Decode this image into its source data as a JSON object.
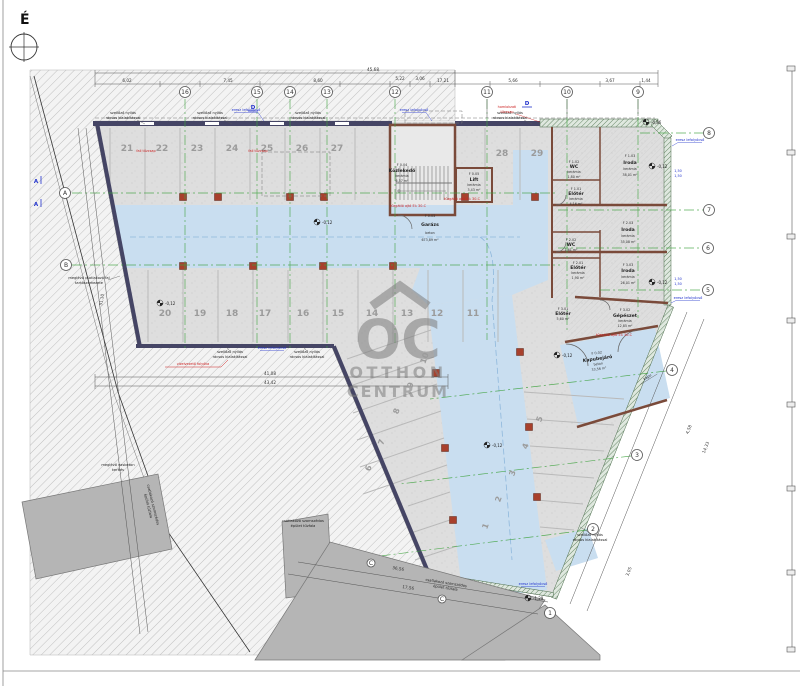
{
  "meta": {
    "north_label": "É"
  },
  "watermark": {
    "monogram": "OC",
    "line1": "OTTHON",
    "line2": "CENTRUM"
  },
  "parking": {
    "top_row": [
      "21",
      "22",
      "23",
      "24",
      "25",
      "26",
      "27",
      "28",
      "29"
    ],
    "middle_row": [
      "20",
      "19",
      "18",
      "17",
      "16",
      "15",
      "14",
      "13",
      "12",
      "11"
    ],
    "wing_left": [
      "10",
      "9",
      "8",
      "7",
      "6"
    ],
    "wing_right": [
      "5",
      "4",
      "3",
      "2",
      "1"
    ]
  },
  "grid": {
    "top": [
      "16",
      "15",
      "14",
      "13",
      "12",
      "11",
      "10",
      "9"
    ],
    "right": [
      "8",
      "7",
      "6",
      "5"
    ],
    "diagonal": [
      "4",
      "3",
      "2",
      "1"
    ],
    "left": [
      "A",
      "B"
    ],
    "sections": {
      "a": "A",
      "d": "D"
    },
    "neighbor_mark": "C"
  },
  "rooms": {
    "garage": {
      "code": "F 0.03",
      "name": "Garázs",
      "finish": "beton",
      "area": "673,89 m²"
    },
    "kozlekedo": {
      "code": "F 0.04",
      "name": "Közlekedő",
      "finish": "kerámia",
      "area": "6,57 m²"
    },
    "lift": {
      "code": "F 0.05",
      "name": "Lift",
      "finish": "kerámia",
      "area": "3,43 m²"
    },
    "wc1": {
      "code": "F 1.02",
      "name": "WC",
      "finish": "kerámia",
      "area": "1,80 m²"
    },
    "iroda1": {
      "code": "F 1.03",
      "name": "Iroda",
      "finish": "kerámia",
      "area": "38,01 m²"
    },
    "eloter1": {
      "code": "F 1.01",
      "name": "Előtér",
      "finish": "kerámia",
      "area": "4,16 m²"
    },
    "iroda2": {
      "code": "F 2.03",
      "name": "Iroda",
      "finish": "kerámia",
      "area": "35,08 m²"
    },
    "wc2": {
      "code": "F 2.02",
      "name": "WC",
      "finish": "kerámia",
      "area": "1,61 m²"
    },
    "eloter2": {
      "code": "F 2.01",
      "name": "Előtér",
      "finish": "kerámia",
      "area": "1,90 m²"
    },
    "iroda3": {
      "code": "F 3.03",
      "name": "Iroda",
      "finish": "kerámia",
      "area": "26,01 m²"
    },
    "eloter3": {
      "code": "F 3.01",
      "name": "Előtér",
      "finish": "kerámia",
      "area": "5,60 m²"
    },
    "gepeszet": {
      "code": "F 3.02",
      "name": "Gépészet",
      "finish": "kerámia",
      "area": "12,85 m²"
    },
    "kapubejaro": {
      "code": "F 0.02",
      "name": "Kapubejáró",
      "finish": "beton",
      "area": "33,56 m²"
    }
  },
  "levels": {
    "garage": "-0,12",
    "street": "-0,86",
    "gate": "-1,29"
  },
  "dimensions": {
    "top_total": "45,68",
    "t1": "6,02",
    "t2": "7,45",
    "t3": "8,60",
    "t4": "5,22",
    "t5": "3,06",
    "t6": "17,21",
    "tr1": "5,66",
    "tr2": "3,67",
    "tr3": "1,44",
    "bottom1": "41,08",
    "bottom2": "43,42",
    "left_total": "31,10",
    "wing1": "36,56",
    "wing2": "17,56",
    "se1": "4,58",
    "se2": "14,33",
    "se3": "3,05",
    "wall_r": "1,50"
  },
  "annotations": {
    "vent_l1": "szellőző nyílás",
    "vent_l2": "rácsos kialakítással",
    "gutter": "eresz lefolyócső",
    "hydrant": "fali tűzcsap",
    "facade_hydrant_l1": "homlokzati",
    "facade_hydrant_l2": "tűzcsap",
    "fire_door": "tűzgátló ajtó EI₂ 30-C",
    "drain": "vízelvezető folyóka",
    "fence_l1": "meglévő vasbeton",
    "fence_l2": "kerítés",
    "exist_l1": "meglévő csatlakozó fal",
    "exist_l2": "tartószerkezete",
    "neighbor_l1": "csatlakozó szomszédos",
    "neighbor_l2": "épület tűzfala",
    "gate": "kapu"
  },
  "colors": {
    "lane_blue": "#c9def0",
    "concrete": "#dedede",
    "hatch_line": "#ababab",
    "wall_dark": "#454565",
    "wall_green": "#5a7d5a",
    "partition_brown": "#7a4a3a",
    "column_red": "#a8402c",
    "grid_green": "#3fa33f",
    "anno_blue": "#2233cc",
    "anno_red": "#cc2222",
    "neighbor_gray": "#b5b5b5",
    "watermark": "#7d7d7d"
  }
}
